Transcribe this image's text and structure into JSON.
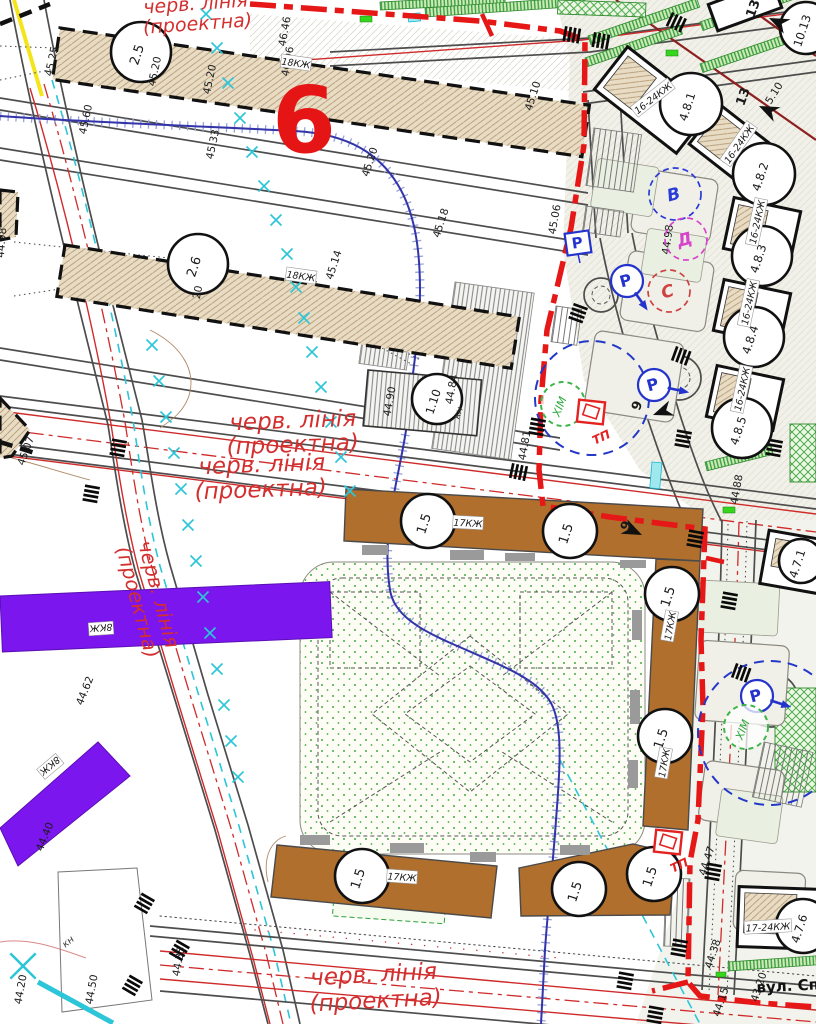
{
  "map": {
    "section_number": "6",
    "street_name": "вул. Сп",
    "khim_label": "ХІМ",
    "tp_label": "ТП",
    "colors": {
      "red_line": "#e61717",
      "thin_red_line": "#cf2b2b",
      "building_brown": "#b06f2c",
      "building_purple": "#7b16ef",
      "building_hatch_beige": "#e9dcc4",
      "water_blue": "#3333aa",
      "tree_mark_cyan": "#2cc6d8",
      "parking_blue": "#2433cc",
      "greenery": "#2f9e3a"
    },
    "red_line_texts": [
      {
        "t": "черв. лінія",
        "x": 196,
        "y": 10,
        "r": -4,
        "s": 19
      },
      {
        "t": "(проектна)",
        "x": 198,
        "y": 30,
        "r": -4,
        "s": 19
      },
      {
        "t": "черв. лінія",
        "x": 293,
        "y": 428,
        "r": -2,
        "s": 23
      },
      {
        "t": "(проектна)",
        "x": 293,
        "y": 452,
        "r": -2,
        "s": 23
      },
      {
        "t": "черв. лінія",
        "x": 262,
        "y": 472,
        "r": -2,
        "s": 23
      },
      {
        "t": "(проектна)",
        "x": 261,
        "y": 497,
        "r": -2,
        "s": 23
      },
      {
        "t": "черв. лінія",
        "x": 152,
        "y": 596,
        "r": 75,
        "s": 20
      },
      {
        "t": "(проектна)",
        "x": 131,
        "y": 604,
        "r": 75,
        "s": 20
      },
      {
        "t": "черв. лінія",
        "x": 374,
        "y": 982,
        "r": -3,
        "s": 23
      },
      {
        "t": "(проектна)",
        "x": 376,
        "y": 1008,
        "r": -3,
        "s": 23
      }
    ],
    "building_circles": [
      {
        "t": "2.5",
        "x": 141,
        "y": 52,
        "rad": 30
      },
      {
        "t": "2.6",
        "x": 198,
        "y": 264,
        "rad": 30
      },
      {
        "t": "1.10",
        "x": 437,
        "y": 399,
        "rad": 25
      },
      {
        "t": "1.5",
        "x": 428,
        "y": 521,
        "rad": 27
      },
      {
        "t": "1.5",
        "x": 570,
        "y": 531,
        "rad": 27
      },
      {
        "t": "1.5",
        "x": 672,
        "y": 594,
        "rad": 27
      },
      {
        "t": "1.5",
        "x": 665,
        "y": 736,
        "rad": 27
      },
      {
        "t": "1.5",
        "x": 362,
        "y": 876,
        "rad": 27
      },
      {
        "t": "1.5",
        "x": 579,
        "y": 889,
        "rad": 27
      },
      {
        "t": "1.5",
        "x": 654,
        "y": 874,
        "rad": 27
      },
      {
        "t": "4.8.1",
        "x": 691,
        "y": 104,
        "rad": 31
      },
      {
        "t": "4.8.2",
        "x": 764,
        "y": 174,
        "rad": 31
      },
      {
        "t": "4.8.3",
        "x": 762,
        "y": 256,
        "rad": 30
      },
      {
        "t": "4.8.4",
        "x": 754,
        "y": 337,
        "rad": 30
      },
      {
        "t": "4.8.5",
        "x": 742,
        "y": 428,
        "rad": 30
      },
      {
        "t": "4.7.1",
        "x": 801,
        "y": 561,
        "rad": 22
      },
      {
        "t": "4.7.6",
        "x": 803,
        "y": 926,
        "rad": 27
      },
      {
        "t": "10.13",
        "x": 806,
        "y": 28,
        "rad": 26
      }
    ],
    "elevations": [
      {
        "t": "45.25",
        "x": 55,
        "y": 62,
        "r": 78
      },
      {
        "t": "45.20",
        "x": 158,
        "y": 72,
        "r": 78
      },
      {
        "t": "45.20",
        "x": 213,
        "y": 80,
        "r": 78
      },
      {
        "t": "45.60",
        "x": 89,
        "y": 120,
        "r": 78
      },
      {
        "t": "45.33",
        "x": 216,
        "y": 145,
        "r": 78
      },
      {
        "t": "46.46",
        "x": 288,
        "y": 32,
        "r": 80
      },
      {
        "t": "46.06",
        "x": 291,
        "y": 62,
        "r": 80
      },
      {
        "t": "45.10",
        "x": 536,
        "y": 97,
        "r": 72
      },
      {
        "t": "45.20",
        "x": 373,
        "y": 163,
        "r": 72
      },
      {
        "t": "45.18",
        "x": 444,
        "y": 224,
        "r": 72
      },
      {
        "t": "45.06",
        "x": 558,
        "y": 220,
        "r": 80
      },
      {
        "t": "45.14",
        "x": 337,
        "y": 266,
        "r": 72
      },
      {
        "t": "20",
        "x": 201,
        "y": 293,
        "r": 78
      },
      {
        "t": "44.98",
        "x": 5,
        "y": 243,
        "r": 85
      },
      {
        "t": "44.98",
        "x": 671,
        "y": 240,
        "r": 82
      },
      {
        "t": "44.90",
        "x": 393,
        "y": 402,
        "r": 80
      },
      {
        "t": "44.84",
        "x": 455,
        "y": 390,
        "r": 80
      },
      {
        "t": "44.81",
        "x": 528,
        "y": 446,
        "r": 80
      },
      {
        "t": "44.88",
        "x": 740,
        "y": 490,
        "r": 80
      },
      {
        "t": "45.07",
        "x": 29,
        "y": 452,
        "r": 70
      },
      {
        "t": "44.62",
        "x": 88,
        "y": 692,
        "r": 68
      },
      {
        "t": "44.40",
        "x": 48,
        "y": 838,
        "r": 68
      },
      {
        "t": "44.20",
        "x": 24,
        "y": 990,
        "r": 80
      },
      {
        "t": "44.50",
        "x": 95,
        "y": 990,
        "r": 80
      },
      {
        "t": "44.35",
        "x": 182,
        "y": 962,
        "r": 80
      },
      {
        "t": "44.47",
        "x": 710,
        "y": 862,
        "r": 72
      },
      {
        "t": "44.38",
        "x": 716,
        "y": 955,
        "r": 72
      },
      {
        "t": "44.15",
        "x": 724,
        "y": 1003,
        "r": 72
      },
      {
        "t": "43.20",
        "x": 762,
        "y": 988,
        "r": 72
      },
      {
        "t": "5.10",
        "x": 777,
        "y": 95,
        "r": 58
      }
    ],
    "storey_labels": [
      {
        "t": "18КЖ",
        "x": 296,
        "y": 63,
        "r": 8
      },
      {
        "t": "18КЖ",
        "x": 301,
        "y": 276,
        "r": 8
      },
      {
        "t": "17КЖ",
        "x": 468,
        "y": 523,
        "r": 3
      },
      {
        "t": "17КЖ",
        "x": 670,
        "y": 626,
        "r": -80
      },
      {
        "t": "17КЖ",
        "x": 664,
        "y": 763,
        "r": -80
      },
      {
        "t": "17КЖ",
        "x": 402,
        "y": 877,
        "r": 4
      },
      {
        "t": "16-24КЖ",
        "x": 653,
        "y": 98,
        "r": -38
      },
      {
        "t": "16-24КЖ",
        "x": 739,
        "y": 144,
        "r": -55
      },
      {
        "t": "16-24КЖ",
        "x": 757,
        "y": 222,
        "r": -78
      },
      {
        "t": "16-24КЖ",
        "x": 749,
        "y": 303,
        "r": -78
      },
      {
        "t": "16-24КЖ",
        "x": 742,
        "y": 389,
        "r": -78
      },
      {
        "t": "17-24КЖ",
        "x": 768,
        "y": 927,
        "r": -3
      },
      {
        "t": "8КЖ",
        "x": 101,
        "y": 628,
        "r": 176
      },
      {
        "t": "8КЖ",
        "x": 50,
        "y": 766,
        "r": 140
      },
      {
        "t": "кн",
        "x": 70,
        "y": 944,
        "r": 40,
        "plain": true
      },
      {
        "t": "кн",
        "x": 461,
        "y": 414,
        "r": 70,
        "plain": true
      }
    ],
    "letter_circles": [
      {
        "t": "В",
        "x": 675,
        "y": 194,
        "rad": 26,
        "c": "#2a3bd8"
      },
      {
        "t": "Д",
        "x": 686,
        "y": 239,
        "rad": 21,
        "c": "#d843cc"
      },
      {
        "t": "С",
        "x": 669,
        "y": 291,
        "rad": 21,
        "c": "#cf4040"
      }
    ],
    "parking": {
      "sign": {
        "t": "Р",
        "x": 578,
        "y": 243
      },
      "circle_label": "Р",
      "circles": [
        {
          "x": 627,
          "y": 281,
          "a": 55
        },
        {
          "x": 654,
          "y": 385,
          "a": 12
        },
        {
          "x": 757,
          "y": 696,
          "a": 18
        }
      ]
    },
    "khim_points": [
      {
        "x": 563,
        "y": 404
      },
      {
        "x": 746,
        "y": 727
      }
    ],
    "tp_points": [
      {
        "x": 591,
        "y": 412,
        "tx": 603,
        "ty": 441
      },
      {
        "x": 668,
        "y": 842,
        "tx": 681,
        "ty": 869
      }
    ],
    "numbered_arrows": [
      {
        "t": "13",
        "x": 757,
        "y": 10,
        "r": 70,
        "ar": 205
      },
      {
        "t": "13",
        "x": 747,
        "y": 98,
        "r": 70,
        "ar": 205
      },
      {
        "t": "9",
        "x": 630,
        "y": 527,
        "r": 70,
        "ar": 25
      },
      {
        "t": "9",
        "x": 641,
        "y": 407,
        "r": 70,
        "ar": 160
      }
    ],
    "crosswalks": [
      [
        565,
        26,
        10
      ],
      [
        594,
        32,
        10
      ],
      [
        672,
        12,
        25
      ],
      [
        588,
        308,
        110
      ],
      [
        676,
        346,
        20
      ],
      [
        692,
        432,
        100
      ],
      [
        546,
        420,
        100
      ],
      [
        512,
        463,
        12
      ],
      [
        127,
        441,
        100
      ],
      [
        100,
        487,
        100
      ],
      [
        155,
        900,
        120
      ],
      [
        190,
        947,
        120
      ],
      [
        143,
        982,
        120
      ],
      [
        722,
        865,
        100
      ],
      [
        688,
        941,
        100
      ],
      [
        783,
        441,
        100
      ],
      [
        738,
        594,
        100
      ],
      [
        736,
        663,
        20
      ],
      [
        634,
        974,
        100
      ],
      [
        664,
        1008,
        100
      ],
      [
        704,
        532,
        100
      ]
    ],
    "tree_marks": [
      [
        206,
        14
      ],
      [
        217,
        48
      ],
      [
        228,
        83
      ],
      [
        240,
        118
      ],
      [
        252,
        152
      ],
      [
        264,
        186
      ],
      [
        276,
        220
      ],
      [
        287,
        254
      ],
      [
        296,
        287
      ],
      [
        304,
        318
      ],
      [
        312,
        352
      ],
      [
        321,
        387
      ],
      [
        331,
        422
      ],
      [
        341,
        457
      ],
      [
        350,
        491
      ],
      [
        152,
        345
      ],
      [
        159,
        381
      ],
      [
        166,
        417
      ],
      [
        174,
        453
      ],
      [
        181,
        489
      ],
      [
        188,
        525
      ],
      [
        196,
        561
      ],
      [
        203,
        597
      ],
      [
        210,
        633
      ],
      [
        217,
        669
      ],
      [
        224,
        705
      ],
      [
        231,
        741
      ],
      [
        238,
        777
      ],
      [
        23,
        966,
        2.3
      ]
    ]
  }
}
